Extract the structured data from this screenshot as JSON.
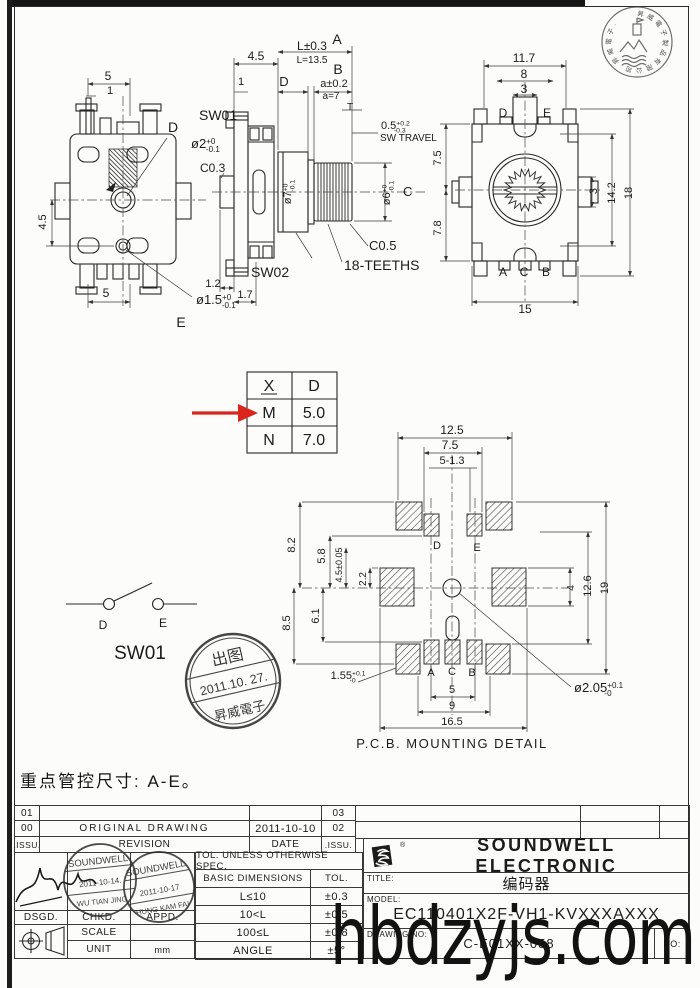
{
  "colors": {
    "arrow_red": "#d9251c",
    "ink": "#272727",
    "stamp_ink": "#2e2e2e"
  },
  "watermark": "hbdzyjs.com",
  "note": "重点管控尺寸: A-E。",
  "spec_table": {
    "rows": [
      [
        "X",
        "D"
      ],
      [
        "M",
        "5.0"
      ],
      [
        "N",
        "7.0"
      ]
    ]
  },
  "release_stamp": {
    "top": "出图",
    "date": "2011.10. 27.",
    "bottom": "昇威電子"
  },
  "corner_stamp": {
    "ring": "昇威電子製品有限公司·昇威電子·"
  },
  "views": {
    "top_view": {
      "labels": [
        {
          "t": "5",
          "x": 108,
          "y": 80,
          "fs": 12
        },
        {
          "t": "1",
          "x": 110,
          "y": 94,
          "fs": 11
        },
        {
          "t": "4.5",
          "x": 46,
          "y": 222,
          "r": -90,
          "fs": 11
        },
        {
          "t": "5",
          "x": 106,
          "y": 297,
          "fs": 12
        },
        {
          "t": "D",
          "x": 173,
          "y": 132,
          "fs": 14
        },
        {
          "t": "ø2",
          "sup": "+0",
          "sub": "-0.1",
          "x": 191,
          "y": 148,
          "fs": 13,
          "a": "start"
        },
        {
          "t": "ø1.5",
          "sup": "+0",
          "sub": "-0.1",
          "x": 196,
          "y": 304,
          "fs": 13,
          "a": "start"
        },
        {
          "t": "E",
          "x": 181,
          "y": 327,
          "fs": 14
        }
      ]
    },
    "side_view": {
      "labels": [
        {
          "t": "4.5",
          "x": 256,
          "y": 60,
          "fs": 12
        },
        {
          "t": "L±0.3",
          "x": 312,
          "y": 50,
          "fs": 12
        },
        {
          "t": "A",
          "x": 337,
          "y": 44,
          "fs": 14
        },
        {
          "t": "L=13.5",
          "x": 312,
          "y": 63,
          "fs": 10
        },
        {
          "t": "1",
          "x": 241,
          "y": 85,
          "fs": 11
        },
        {
          "t": "D",
          "x": 284,
          "y": 86,
          "fs": 13
        },
        {
          "t": "B",
          "x": 338,
          "y": 74,
          "fs": 14
        },
        {
          "t": "a±0.2",
          "x": 334,
          "y": 87,
          "fs": 11
        },
        {
          "t": "a=7",
          "x": 331,
          "y": 99,
          "fs": 10
        },
        {
          "t": "T",
          "x": 350,
          "y": 110,
          "fs": 10
        },
        {
          "t": "0.5",
          "sup": "+0.2",
          "sub": "-0.3",
          "x": 381,
          "y": 129,
          "fs": 11,
          "a": "start"
        },
        {
          "t": "SW TRAVEL",
          "x": 380,
          "y": 141,
          "fs": 10,
          "a": "start"
        },
        {
          "t": "SW01",
          "x": 199,
          "y": 120,
          "fs": 14,
          "a": "start"
        },
        {
          "t": "C0.3",
          "x": 200,
          "y": 172,
          "fs": 12,
          "a": "start"
        },
        {
          "t": "ø7",
          "sup": "+0",
          "sub": "-0.1",
          "x": 291,
          "y": 192,
          "r": -90,
          "fs": 11
        },
        {
          "t": "ø6",
          "sup": "+0",
          "sub": "-0.1",
          "x": 390,
          "y": 193,
          "r": -90,
          "fs": 11
        },
        {
          "t": "C",
          "x": 403,
          "y": 196,
          "fs": 13,
          "a": "start"
        },
        {
          "t": "C0.5",
          "x": 369,
          "y": 250,
          "fs": 13,
          "a": "start"
        },
        {
          "t": "18-TEETHS",
          "x": 344,
          "y": 270,
          "fs": 14,
          "a": "start"
        },
        {
          "t": "SW02",
          "x": 251,
          "y": 277,
          "fs": 14,
          "a": "start"
        },
        {
          "t": "1.2",
          "x": 213,
          "y": 287,
          "fs": 11
        },
        {
          "t": "1.7",
          "x": 245,
          "y": 298,
          "fs": 11
        }
      ]
    },
    "front_view": {
      "labels": [
        {
          "t": "11.7",
          "x": 524,
          "y": 62,
          "fs": 12
        },
        {
          "t": "8",
          "x": 524,
          "y": 78,
          "fs": 12
        },
        {
          "t": "3",
          "x": 524,
          "y": 93,
          "fs": 12
        },
        {
          "t": "D",
          "x": 503,
          "y": 117,
          "fs": 12
        },
        {
          "t": "E",
          "x": 547,
          "y": 117,
          "fs": 12
        },
        {
          "t": "7.5",
          "x": 441,
          "y": 158,
          "r": -90,
          "fs": 11
        },
        {
          "t": "7.8",
          "x": 441,
          "y": 228,
          "r": -90,
          "fs": 11
        },
        {
          "t": "3",
          "x": 597,
          "y": 191,
          "r": -90,
          "fs": 11
        },
        {
          "t": "14.2",
          "x": 615,
          "y": 193,
          "r": -90,
          "fs": 11
        },
        {
          "t": "18",
          "x": 632,
          "y": 193,
          "r": -90,
          "fs": 11
        },
        {
          "t": "A",
          "x": 503,
          "y": 276,
          "fs": 12
        },
        {
          "t": "C",
          "x": 524,
          "y": 276,
          "fs": 12
        },
        {
          "t": "B",
          "x": 546,
          "y": 276,
          "fs": 12
        },
        {
          "t": "15",
          "x": 525,
          "y": 313,
          "fs": 12
        }
      ]
    },
    "pcb_detail": {
      "title": "P.C.B. MOUNTING DETAIL",
      "labels": [
        {
          "t": "12.5",
          "x": 452,
          "y": 434,
          "fs": 12
        },
        {
          "t": "7.5",
          "x": 450,
          "y": 449,
          "fs": 12
        },
        {
          "t": "5-1.3",
          "x": 452,
          "y": 464,
          "fs": 11
        },
        {
          "t": "8.2",
          "x": 295,
          "y": 545,
          "r": -90,
          "fs": 11
        },
        {
          "t": "5.8",
          "x": 325,
          "y": 556,
          "r": -90,
          "fs": 11
        },
        {
          "t": "4.5±0.05",
          "x": 342,
          "y": 565,
          "r": -90,
          "fs": 9
        },
        {
          "t": "2.2",
          "x": 366,
          "y": 579,
          "r": -90,
          "fs": 10
        },
        {
          "t": "6.1",
          "x": 319,
          "y": 616,
          "r": -90,
          "fs": 11
        },
        {
          "t": "8.5",
          "x": 290,
          "y": 623,
          "r": -90,
          "fs": 11
        },
        {
          "t": "D",
          "x": 437,
          "y": 549,
          "fs": 11
        },
        {
          "t": "E",
          "x": 477,
          "y": 551,
          "fs": 11
        },
        {
          "t": "4",
          "x": 574,
          "y": 588,
          "r": -90,
          "fs": 10
        },
        {
          "t": "12.6",
          "x": 591,
          "y": 586,
          "r": -90,
          "fs": 11
        },
        {
          "t": "19",
          "x": 608,
          "y": 588,
          "r": -90,
          "fs": 11
        },
        {
          "t": "A",
          "x": 431,
          "y": 676,
          "fs": 11
        },
        {
          "t": "C",
          "x": 452,
          "y": 675,
          "fs": 11
        },
        {
          "t": "B",
          "x": 472,
          "y": 676,
          "fs": 11
        },
        {
          "t": "1.55",
          "sup": "+0.1",
          "sub": "-0",
          "x": 348,
          "y": 679,
          "fs": 11
        },
        {
          "t": "5",
          "x": 452,
          "y": 693,
          "fs": 11
        },
        {
          "t": "9",
          "x": 452,
          "y": 709,
          "fs": 11
        },
        {
          "t": "16.5",
          "x": 452,
          "y": 725,
          "fs": 11
        },
        {
          "t": "ø2.05",
          "sup": "+0.1",
          "sub": "-0",
          "x": 574,
          "y": 692,
          "fs": 13,
          "a": "start"
        }
      ]
    },
    "sw_schematic": {
      "labels": [
        {
          "t": "D",
          "x": 103,
          "y": 629,
          "fs": 12
        },
        {
          "t": "E",
          "x": 163,
          "y": 627,
          "fs": 12
        },
        {
          "t": "SW01",
          "x": 140,
          "y": 659,
          "fs": 19
        }
      ]
    }
  },
  "revision": {
    "left": {
      "rows": [
        {
          "issue": "01",
          "desc": "",
          "date": "",
          "issue2": "03"
        },
        {
          "issue": "00",
          "desc": "ORIGINAL  DRAWING",
          "date": "2011-10-10",
          "issue2": "02"
        },
        {
          "issue": ".ISSU.",
          "desc": "REVISION",
          "date": "DATE",
          "issue2": ".ISSU."
        }
      ]
    },
    "right": {
      "rows": [
        [
          "",
          "",
          ""
        ],
        [
          "",
          "",
          ""
        ]
      ]
    }
  },
  "approval": {
    "dsgd": "DSGD.",
    "chkd": "CHKD.",
    "appd": "APPD.",
    "scale_label": "SCALE",
    "scale_value": "",
    "unit_label": "UNIT",
    "unit_value": "mm",
    "stamp1": {
      "company": "SOUNDWELL",
      "date": "2011-10-14.",
      "name": "WU TIAN JING"
    },
    "stamp2": {
      "company": "SOUNDWELL",
      "date": "2011-10-17",
      "name": "HUNG KAM FAI"
    }
  },
  "tolerance": {
    "header": "TOL. UNLESS OTHERWISE SPEC.",
    "col1": "BASIC DIMENSIONS",
    "col2": "TOL.",
    "rows": [
      [
        "L≤10",
        "±0.3"
      ],
      [
        "10<L",
        "±0.5"
      ],
      [
        "100≤L",
        "±0.8"
      ],
      [
        "ANGLE",
        "±5°"
      ]
    ]
  },
  "title_block": {
    "company": "SOUNDWELL  ELECTRONIC",
    "reg": "®",
    "title_label": "TITLE:",
    "title": "编码器",
    "model_label": "MODEL:",
    "model": "EC110401X2F-VH1-KVXXXAXXX",
    "drawing_no_label": "DRAWING NO:",
    "drawing_no": "C-E01XX-058",
    "no_label": "NO:"
  }
}
